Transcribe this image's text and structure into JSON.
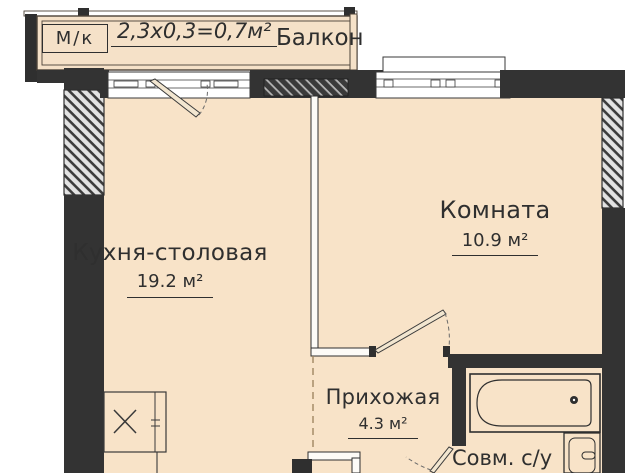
{
  "plan_title": "apartment-floor-plan",
  "balcony": {
    "marking": "М/к",
    "dimension": "2,3x0,3=0,7м²",
    "name": "Балкон"
  },
  "rooms": {
    "kitchen": {
      "name": "Кухня-столовая",
      "area": "19.2 м²"
    },
    "room": {
      "name": "Комната",
      "area": "10.9 м²"
    },
    "hallway": {
      "name": "Прихожая",
      "area": "4.3 м²"
    },
    "bathroom": {
      "name": "Совм. с/у"
    }
  },
  "colors": {
    "floor": "#f8e3c8",
    "balcony_floor": "#f5e1c8",
    "wall": "#333333",
    "outline": "#4c4238",
    "dashed_line": "#a08662",
    "text": "#2f2f2f"
  }
}
